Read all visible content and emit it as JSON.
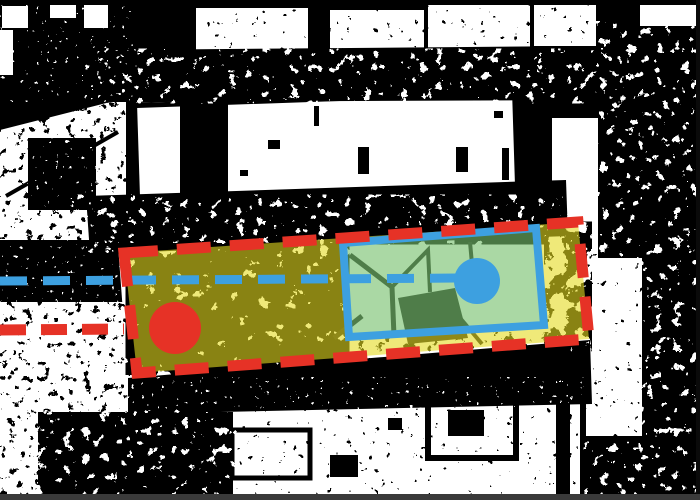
{
  "canvas": {
    "width": 700,
    "height": 500
  },
  "overlay": {
    "colors": {
      "red": "#e63226",
      "blue": "#3da0e0",
      "yellow": "rgba(228,218,32,0.60)",
      "green": "rgba(118,192,108,0.62)"
    },
    "red_dashed_box": {
      "points": [
        [
          124,
          253
        ],
        [
          578,
          222
        ],
        [
          589,
          339
        ],
        [
          137,
          373
        ]
      ],
      "stroke_width": 11,
      "dash": "34 19"
    },
    "blue_solid_box": {
      "points": [
        [
          343,
          243
        ],
        [
          536,
          228
        ],
        [
          544,
          325
        ],
        [
          349,
          337
        ]
      ],
      "stroke_width": 8
    },
    "blue_dashed_line": {
      "from": [
        0,
        281
      ],
      "to": [
        466,
        278
      ],
      "width": 9,
      "dash": "27 16"
    },
    "red_dashed_line": {
      "from": [
        0,
        330
      ],
      "to": [
        124,
        329
      ],
      "width": 11,
      "dash": "26 15"
    },
    "red_marker": {
      "center": [
        175,
        328
      ],
      "radius": 26
    },
    "blue_marker": {
      "center": [
        477,
        281
      ],
      "radius": 23
    }
  }
}
